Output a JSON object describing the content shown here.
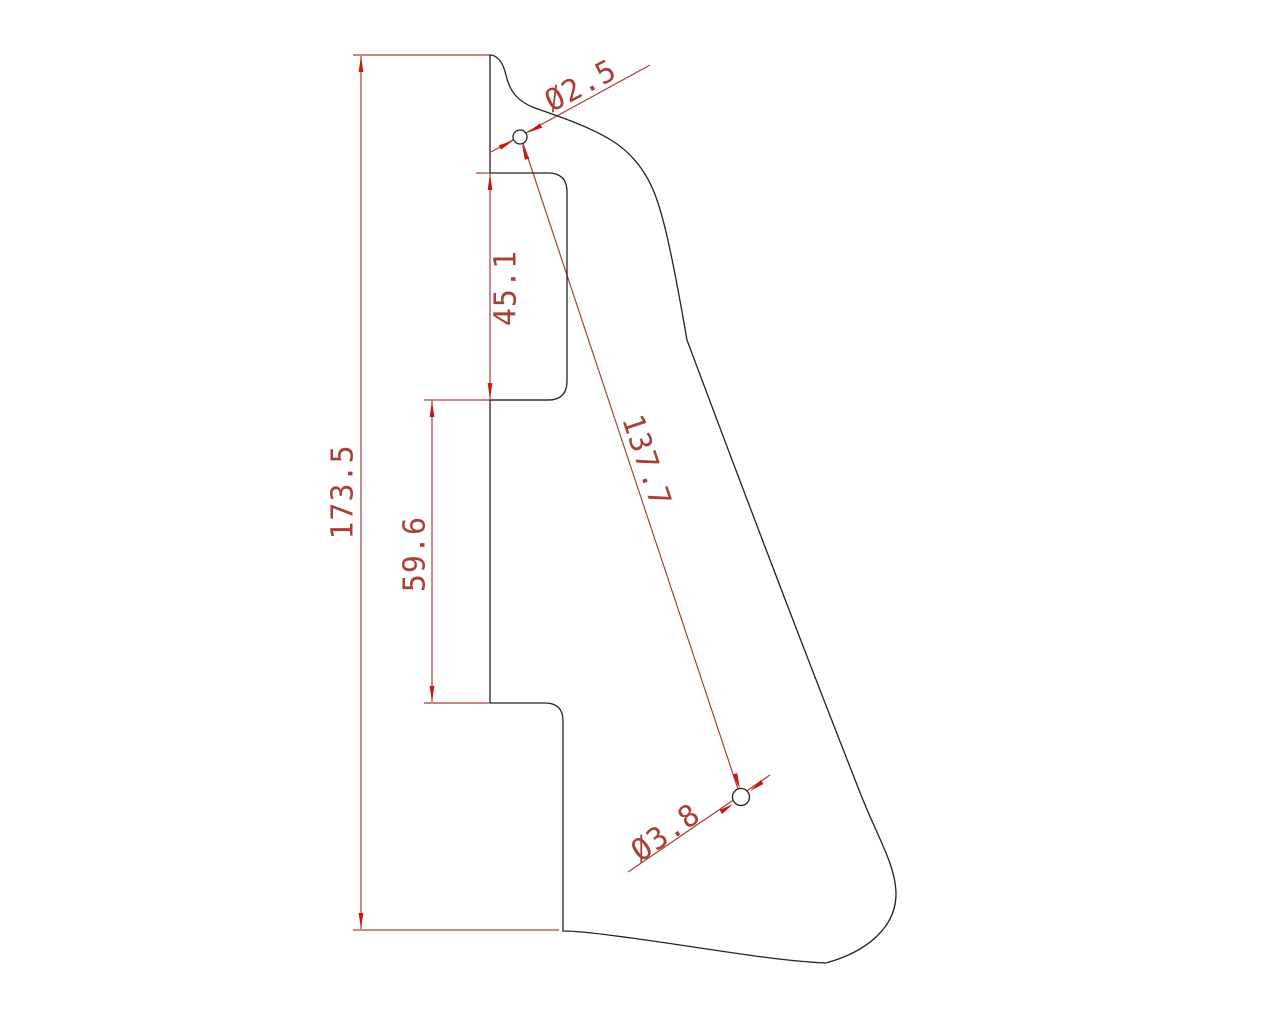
{
  "colors": {
    "background": "#ffffff",
    "part_outline": "#222222",
    "dimension_lines": "#a8403a",
    "dimension_text": "#a8403a",
    "arrowheads": "#c41a10"
  },
  "dimensions": {
    "overall_height": "173.5",
    "upper_edge_section": "45.1",
    "middle_edge_section": "59.6",
    "hole_to_hole_distance": "137.7",
    "top_hole_diameter": "Ø2.5",
    "bottom_hole_diameter": "Ø3.8"
  }
}
